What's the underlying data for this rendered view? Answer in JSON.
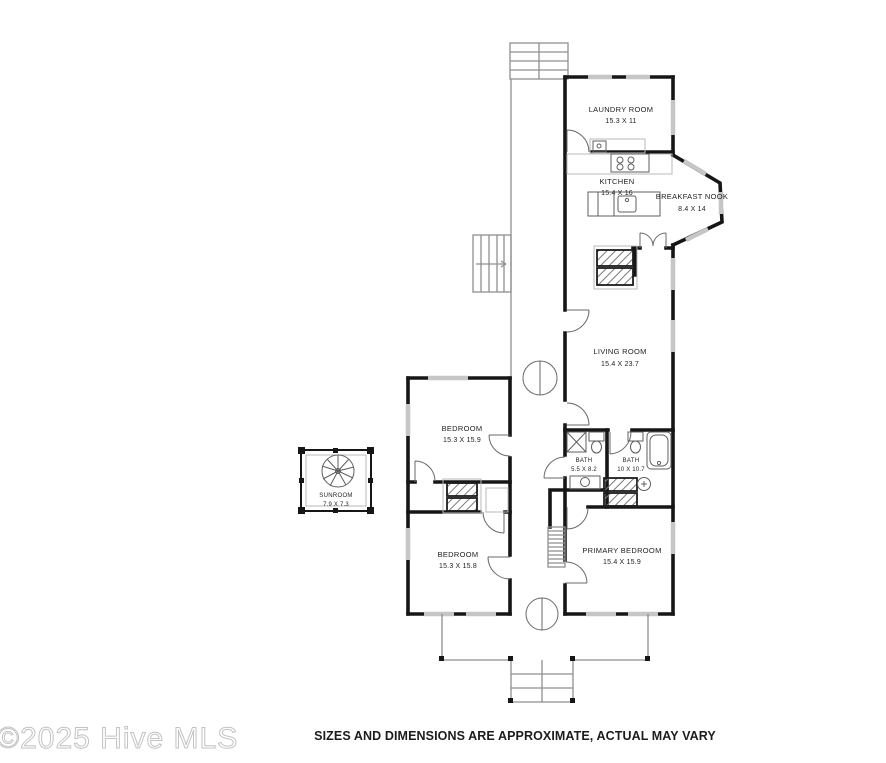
{
  "plan_title": "Single story floor plan",
  "rooms": {
    "laundry": {
      "name": "LAUNDRY ROOM",
      "dims": "15.3 X 11"
    },
    "kitchen": {
      "name": "KITCHEN",
      "dims": "15.4 X 16"
    },
    "breakfast_nook": {
      "name": "BREAKFAST NOOK",
      "dims": "8.4 X 14"
    },
    "living": {
      "name": "LIVING ROOM",
      "dims": "15.4 X 23.7"
    },
    "bath_small": {
      "name": "BATH",
      "dims": "5.5 X 8.2"
    },
    "bath_large": {
      "name": "BATH",
      "dims": "10 X 10.7"
    },
    "primary": {
      "name": "PRIMARY BEDROOM",
      "dims": "15.4 X 15.9"
    },
    "bedroom_upper": {
      "name": "BEDROOM",
      "dims": "15.3 X 15.9"
    },
    "bedroom_lower": {
      "name": "BEDROOM",
      "dims": "15.3 X 15.8"
    },
    "sunroom": {
      "name": "SUNROOM",
      "dims": "7.9 X 7.3"
    }
  },
  "footer": {
    "watermark": "©2025 Hive MLS",
    "disclaimer": "SIZES AND DIMENSIONS ARE APPROXIMATE, ACTUAL MAY VARY"
  },
  "colors": {
    "wall": "#161616",
    "window": "#c6c6c6",
    "porch_line": "#8f8f8f",
    "watermark": "#c3c3c3",
    "background": "#ffffff"
  }
}
